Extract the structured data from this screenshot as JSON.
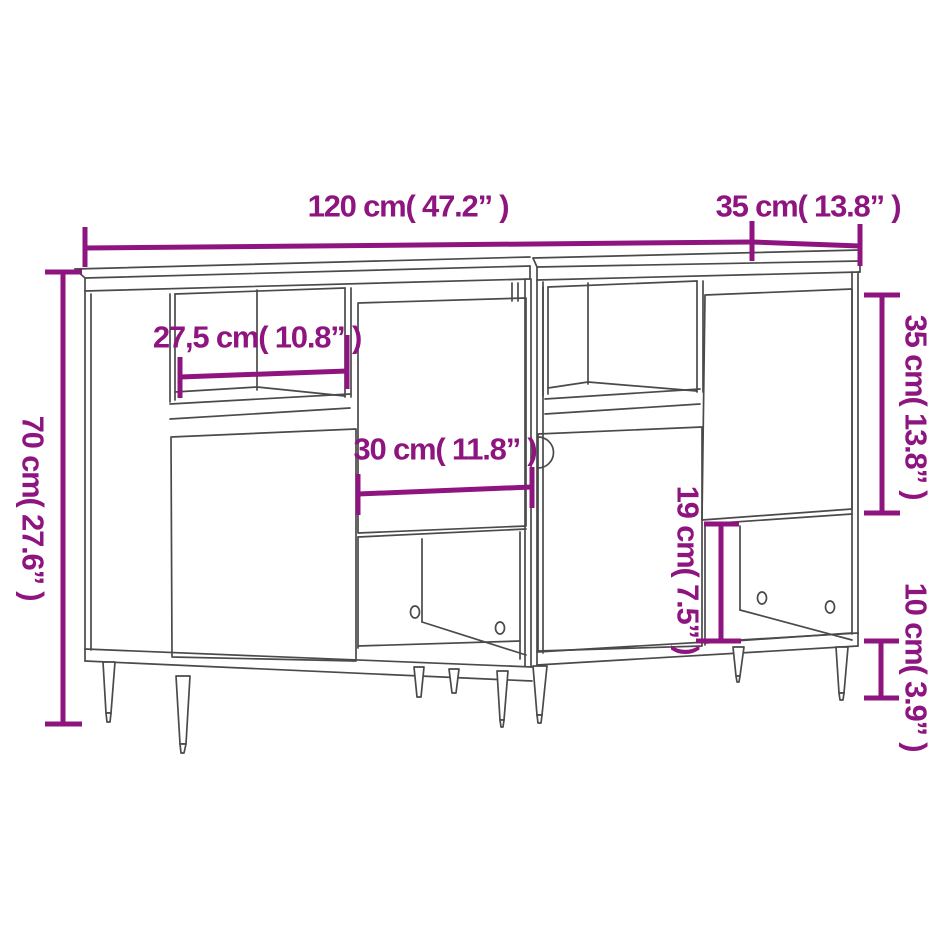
{
  "colors": {
    "dimension_accent": "#8e157f",
    "line_art": "#4a4a4a",
    "background": "#ffffff"
  },
  "diagram": {
    "subject": "Two sideboards side by side, perspective line drawing with dimension callouts",
    "dimensions": [
      {
        "id": "overall_width",
        "label": "120 cm( 47.2” )",
        "value_cm": 120,
        "value_in": 47.2,
        "orientation": "horizontal"
      },
      {
        "id": "depth_top",
        "label": "35 cm( 13.8” )",
        "value_cm": 35,
        "value_in": 13.8,
        "orientation": "horizontal"
      },
      {
        "id": "shelf_width",
        "label": "27,5 cm( 10.8” )",
        "value_cm": 27.5,
        "value_in": 10.8,
        "orientation": "horizontal"
      },
      {
        "id": "door_width",
        "label": "30 cm( 11.8” )",
        "value_cm": 30,
        "value_in": 11.8,
        "orientation": "horizontal"
      },
      {
        "id": "overall_height",
        "label": "70 cm( 27.6” )",
        "value_cm": 70,
        "value_in": 27.6,
        "orientation": "vertical"
      },
      {
        "id": "upper_door_height",
        "label": "35 cm( 13.8” )",
        "value_cm": 35,
        "value_in": 13.8,
        "orientation": "vertical"
      },
      {
        "id": "lower_compartment_height",
        "label": "19 cm( 7.5” )",
        "value_cm": 19,
        "value_in": 7.5,
        "orientation": "vertical"
      },
      {
        "id": "leg_height",
        "label": "10 cm( 3.9” )",
        "value_cm": 10,
        "value_in": 3.9,
        "orientation": "vertical"
      }
    ]
  }
}
